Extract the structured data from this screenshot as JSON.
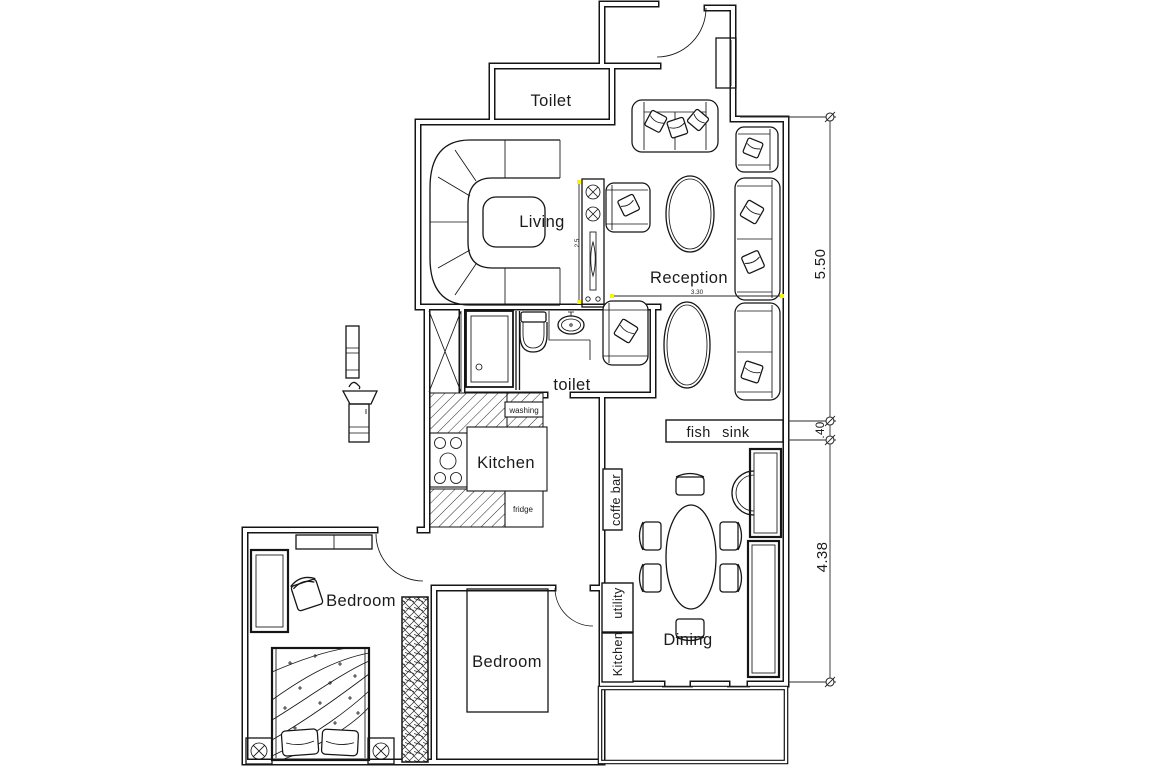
{
  "drawing": {
    "type": "apartment-floor-plan",
    "style": "CAD black-line drawing on white"
  },
  "labels": {
    "toilet_top": "Toilet",
    "living": "Living",
    "reception": "Reception",
    "toilet_small": "toilet",
    "kitchen": "Kitchen",
    "bedroom_left": "Bedroom",
    "bedroom_right": "Bedroom",
    "dining": "Dining"
  },
  "annotations": {
    "washing": "washing",
    "fridge": "fridge",
    "fish_sink": "fish sink",
    "coffe_bar": "coffe bar",
    "utility": "utility",
    "kitchen_cabinet": "Kitchen"
  },
  "dimensions": {
    "reception_height": "5.50",
    "wall_offset": ".40",
    "dining_height": "4.38",
    "reception_width": "3.30",
    "console": "2.5"
  },
  "colors": {
    "line": "#151515",
    "background": "#ffffff",
    "accent": "#f7f700"
  }
}
